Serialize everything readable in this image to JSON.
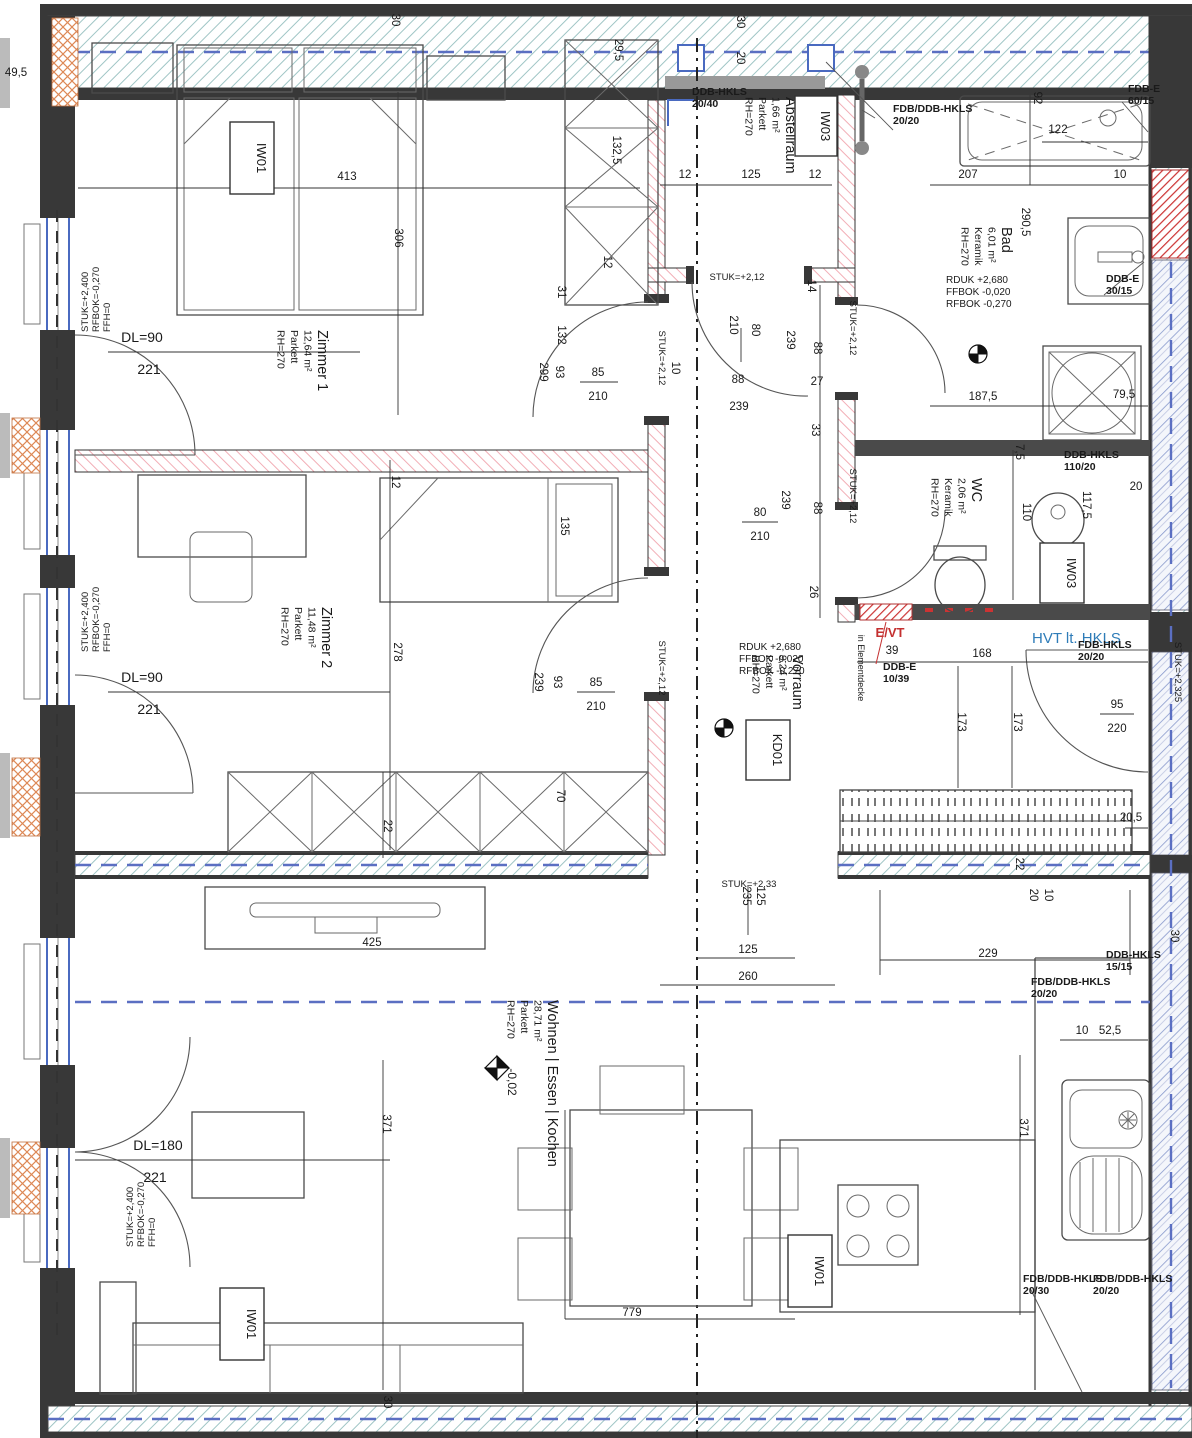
{
  "colors": {
    "wall": "#383838",
    "pink_hatch": "#f2aeb6",
    "insulation_hatch": "#9fc5c5",
    "blue_dash": "#5b6fc2",
    "glazing": "#8899cc",
    "orange_hatch": "#dd8855",
    "red": "#c43030",
    "blue_text": "#2e7cb8",
    "dim_text": "#1a1a1a"
  },
  "rooms": [
    {
      "name": "Zimmer 1",
      "area": "12,64 m²",
      "floor": "Parkett",
      "height": "RH=270",
      "x": 318,
      "y": 330
    },
    {
      "name": "Zimmer 2",
      "area": "11,48 m²",
      "floor": "Parkett",
      "height": "RH=270",
      "x": 322,
      "y": 607
    },
    {
      "name": "Abstellraum",
      "area": "1,66 m²",
      "floor": "Parkett",
      "height": "RH=270",
      "x": 786,
      "y": 97
    },
    {
      "name": "Bad",
      "area": "6,01 m²",
      "floor": "Keramik",
      "height": "RH=270",
      "x": 1002,
      "y": 227
    },
    {
      "name": "WC",
      "area": "2,06 m²",
      "floor": "Keramik",
      "height": "RH=270",
      "x": 972,
      "y": 478
    },
    {
      "name": "Vorraum",
      "area": "9,24 m²",
      "floor": "Parkett",
      "height": "RH=270",
      "x": 793,
      "y": 655
    },
    {
      "name": "Wohnen | Essen | Kochen",
      "area": "28,71 m²",
      "floor": "Parkett",
      "height": "RH=270",
      "x": 548,
      "y": 1000
    }
  ],
  "level_blocks": [
    {
      "lines": [
        "STUK=+2,400",
        "RFBOK=-0,270",
        "FFH=0"
      ],
      "x": 88,
      "y": 332
    },
    {
      "lines": [
        "STUK=+2,400",
        "RFBOK=-0,270",
        "FFH=0"
      ],
      "x": 88,
      "y": 652
    },
    {
      "lines": [
        "STUK=+2,400",
        "RFBOK=-0,270",
        "FFH=0"
      ],
      "x": 133,
      "y": 1247
    }
  ],
  "rduk_blocks": [
    {
      "lines": [
        "RDUK +2,680",
        "FFBOK -0,020",
        "RFBOK -0,270"
      ],
      "x": 946,
      "y": 283
    },
    {
      "lines": [
        "RDUK +2,680",
        "FFBOK -0,020",
        "RFBOK -0,270"
      ],
      "x": 739,
      "y": 650
    }
  ],
  "note_blocks": [
    {
      "lines": [
        "DDB-HKLS",
        "20/40"
      ],
      "x": 692,
      "y": 95
    },
    {
      "lines": [
        "FDB/DDB-HKLS",
        "20/20"
      ],
      "x": 893,
      "y": 112
    },
    {
      "lines": [
        "FDB-E",
        "60/15"
      ],
      "x": 1128,
      "y": 92
    },
    {
      "lines": [
        "DDB-E",
        "30/15"
      ],
      "x": 1106,
      "y": 282
    },
    {
      "lines": [
        "DDB-HKLS",
        "110/20"
      ],
      "x": 1064,
      "y": 458
    },
    {
      "lines": [
        "DDB-E",
        "10/39"
      ],
      "x": 883,
      "y": 670
    },
    {
      "lines": [
        "FDB-HKLS",
        "20/20"
      ],
      "x": 1078,
      "y": 648
    },
    {
      "lines": [
        "DDB-HKLS",
        "15/15"
      ],
      "x": 1106,
      "y": 958
    },
    {
      "lines": [
        "FDB/DDB-HKLS",
        "20/20"
      ],
      "x": 1031,
      "y": 985
    },
    {
      "lines": [
        "FDB/DDB-HKLS",
        "20/30"
      ],
      "x": 1023,
      "y": 1282
    },
    {
      "lines": [
        "FDB/DDB-HKLS",
        "20/20"
      ],
      "x": 1093,
      "y": 1282
    }
  ],
  "boxed_labels": [
    {
      "text": "IW01",
      "x": 230,
      "y": 122,
      "w": 44,
      "h": 72
    },
    {
      "text": "IW03",
      "x": 795,
      "y": 96,
      "w": 42,
      "h": 60
    },
    {
      "text": "IW03",
      "x": 1040,
      "y": 543,
      "w": 44,
      "h": 60
    },
    {
      "text": "KD01",
      "x": 746,
      "y": 720,
      "w": 44,
      "h": 60
    },
    {
      "text": "IW01",
      "x": 788,
      "y": 1235,
      "w": 44,
      "h": 72
    },
    {
      "text": "IW01",
      "x": 220,
      "y": 1288,
      "w": 44,
      "h": 72
    }
  ],
  "special_texts": [
    {
      "t": "E/VT",
      "x": 890,
      "y": 637,
      "s": 13,
      "c": "#c43030",
      "b": true,
      "n": "evt-label"
    },
    {
      "t": "HVT lt. HKLS",
      "x": 1032,
      "y": 643,
      "s": 15,
      "c": "#2e7cb8",
      "a": "start",
      "n": "hvt-hkls-label"
    },
    {
      "t": "in Elementdecke",
      "x": 858,
      "y": 668,
      "r": 90,
      "s": 9,
      "n": "elementdecke-note"
    },
    {
      "t": "-0,02",
      "x": 508,
      "y": 1082,
      "r": 90,
      "s": 12,
      "n": "level-value"
    }
  ],
  "dims": [
    {
      "t": "49,5",
      "x": 16,
      "y": 76
    },
    {
      "t": "30",
      "x": 392,
      "y": 20,
      "r": 90
    },
    {
      "t": "30",
      "x": 737,
      "y": 22,
      "r": 90
    },
    {
      "t": "20",
      "x": 737,
      "y": 58,
      "r": 90
    },
    {
      "t": "29,5",
      "x": 615,
      "y": 50,
      "r": 90
    },
    {
      "t": "132,5",
      "x": 613,
      "y": 150,
      "r": 90
    },
    {
      "t": "12",
      "x": 604,
      "y": 262,
      "r": 90
    },
    {
      "t": "31",
      "x": 558,
      "y": 292,
      "r": 90
    },
    {
      "t": "132",
      "x": 558,
      "y": 335,
      "r": 90
    },
    {
      "t": "413",
      "x": 347,
      "y": 180
    },
    {
      "t": "306",
      "x": 395,
      "y": 238,
      "r": 90
    },
    {
      "t": "DL=90",
      "x": 142,
      "y": 342,
      "s": 14
    },
    {
      "t": "221",
      "x": 149,
      "y": 374,
      "s": 14
    },
    {
      "t": "10",
      "x": 672,
      "y": 368,
      "r": 90
    },
    {
      "t": "85",
      "x": 598,
      "y": 376
    },
    {
      "t": "210",
      "x": 598,
      "y": 400
    },
    {
      "t": "93",
      "x": 556,
      "y": 372,
      "r": 90
    },
    {
      "t": "299",
      "x": 540,
      "y": 372,
      "r": 90
    },
    {
      "t": "STUK=+2,12",
      "x": 659,
      "y": 358,
      "r": 90,
      "s": 9.5
    },
    {
      "t": "12",
      "x": 685,
      "y": 178
    },
    {
      "t": "125",
      "x": 751,
      "y": 178
    },
    {
      "t": "12",
      "x": 815,
      "y": 178
    },
    {
      "t": "STUK=+2,12",
      "x": 737,
      "y": 280,
      "s": 9.5
    },
    {
      "t": "14",
      "x": 808,
      "y": 286,
      "r": 90
    },
    {
      "t": "92",
      "x": 1034,
      "y": 98,
      "r": 90
    },
    {
      "t": "122",
      "x": 1058,
      "y": 133
    },
    {
      "t": "207",
      "x": 968,
      "y": 178
    },
    {
      "t": "10",
      "x": 1120,
      "y": 178
    },
    {
      "t": "290,5",
      "x": 1022,
      "y": 222,
      "r": 90
    },
    {
      "t": "187,5",
      "x": 983,
      "y": 400
    },
    {
      "t": "79,5",
      "x": 1124,
      "y": 398
    },
    {
      "t": "80",
      "x": 752,
      "y": 330,
      "r": 90
    },
    {
      "t": "210",
      "x": 730,
      "y": 325,
      "r": 90
    },
    {
      "t": "88",
      "x": 738,
      "y": 383
    },
    {
      "t": "239",
      "x": 739,
      "y": 410
    },
    {
      "t": "239",
      "x": 787,
      "y": 340,
      "r": 90
    },
    {
      "t": "88",
      "x": 814,
      "y": 348,
      "r": 90
    },
    {
      "t": "27",
      "x": 817,
      "y": 385
    },
    {
      "t": "STUK=+2,12",
      "x": 850,
      "y": 328,
      "r": 90,
      "s": 9.5
    },
    {
      "t": "33",
      "x": 812,
      "y": 430,
      "r": 90
    },
    {
      "t": "88",
      "x": 814,
      "y": 508,
      "r": 90
    },
    {
      "t": "26",
      "x": 810,
      "y": 592,
      "r": 90
    },
    {
      "t": "80",
      "x": 760,
      "y": 516
    },
    {
      "t": "210",
      "x": 760,
      "y": 540
    },
    {
      "t": "239",
      "x": 782,
      "y": 500,
      "r": 90
    },
    {
      "t": "STUK=+2,12",
      "x": 850,
      "y": 496,
      "r": 90,
      "s": 9.5
    },
    {
      "t": "7,5",
      "x": 1016,
      "y": 452,
      "r": 90
    },
    {
      "t": "110",
      "x": 1023,
      "y": 512,
      "r": 90
    },
    {
      "t": "117,5",
      "x": 1083,
      "y": 505,
      "r": 90
    },
    {
      "t": "20",
      "x": 1136,
      "y": 490
    },
    {
      "t": "39",
      "x": 892,
      "y": 654
    },
    {
      "t": "168",
      "x": 982,
      "y": 657
    },
    {
      "t": "173",
      "x": 958,
      "y": 722,
      "r": 90
    },
    {
      "t": "173",
      "x": 1014,
      "y": 722,
      "r": 90
    },
    {
      "t": "95",
      "x": 1117,
      "y": 708
    },
    {
      "t": "220",
      "x": 1117,
      "y": 732
    },
    {
      "t": "STUK=+2,325",
      "x": 1175,
      "y": 672,
      "r": 90,
      "s": 9.5
    },
    {
      "t": "20,5",
      "x": 1131,
      "y": 821
    },
    {
      "t": "22",
      "x": 1016,
      "y": 864,
      "r": 90
    },
    {
      "t": "20",
      "x": 1030,
      "y": 895,
      "r": 90
    },
    {
      "t": "10",
      "x": 1045,
      "y": 895,
      "r": 90
    },
    {
      "t": "STUK=+2,33",
      "x": 749,
      "y": 887,
      "s": 9.5
    },
    {
      "t": "125",
      "x": 757,
      "y": 896,
      "r": 90
    },
    {
      "t": "235",
      "x": 743,
      "y": 896,
      "r": 90
    },
    {
      "t": "125",
      "x": 748,
      "y": 953
    },
    {
      "t": "260",
      "x": 748,
      "y": 980
    },
    {
      "t": "229",
      "x": 988,
      "y": 957
    },
    {
      "t": "425",
      "x": 372,
      "y": 946
    },
    {
      "t": "22",
      "x": 384,
      "y": 826,
      "r": 90
    },
    {
      "t": "70",
      "x": 557,
      "y": 796,
      "r": 90
    },
    {
      "t": "12",
      "x": 392,
      "y": 482,
      "r": 90
    },
    {
      "t": "278",
      "x": 394,
      "y": 652,
      "r": 90
    },
    {
      "t": "135",
      "x": 561,
      "y": 526,
      "r": 90
    },
    {
      "t": "DL=90",
      "x": 142,
      "y": 682,
      "s": 14
    },
    {
      "t": "221",
      "x": 149,
      "y": 714,
      "s": 14
    },
    {
      "t": "85",
      "x": 596,
      "y": 686
    },
    {
      "t": "210",
      "x": 596,
      "y": 710
    },
    {
      "t": "93",
      "x": 554,
      "y": 682,
      "r": 90
    },
    {
      "t": "239",
      "x": 535,
      "y": 682,
      "r": 90
    },
    {
      "t": "STUK=+2,12",
      "x": 659,
      "y": 668,
      "r": 90,
      "s": 9.5
    },
    {
      "t": "DL=180",
      "x": 158,
      "y": 1150,
      "s": 14
    },
    {
      "t": "221",
      "x": 155,
      "y": 1182,
      "s": 14
    },
    {
      "t": "371",
      "x": 383,
      "y": 1124,
      "r": 90
    },
    {
      "t": "371",
      "x": 1020,
      "y": 1128,
      "r": 90
    },
    {
      "t": "779",
      "x": 632,
      "y": 1316
    },
    {
      "t": "10",
      "x": 1082,
      "y": 1034
    },
    {
      "t": "52,5",
      "x": 1110,
      "y": 1034
    },
    {
      "t": "30",
      "x": 1171,
      "y": 936,
      "r": 90
    },
    {
      "t": "30",
      "x": 384,
      "y": 1402,
      "r": 90
    }
  ]
}
